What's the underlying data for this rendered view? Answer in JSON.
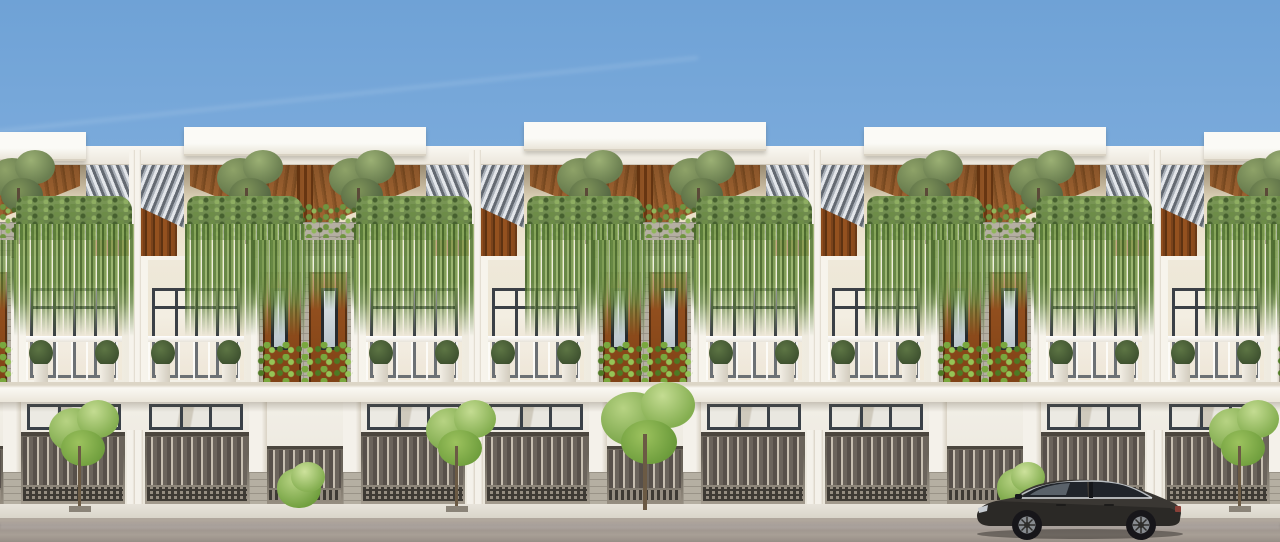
{
  "scene": {
    "type": "architectural-exterior-render",
    "subject": "Row of modern three-storey townhouses with timber slat accents, hanging balcony greenery, slatted metal fences, street trees and a parked charcoal wagon",
    "time_of_day": "day",
    "palette": {
      "sky_top": "#6fa2d6",
      "sky_horizon": "#a5c8e8",
      "facade_white": "#f6f3ec",
      "wall_cream": "#f0e8d6",
      "timber_brown": "#94511f",
      "wood_ceiling": "#9c6130",
      "louver_gray": "#9aa0a8",
      "window_frame": "#3a4148",
      "foliage_olive": "#79905a",
      "vine_green": "#7a9952",
      "street_tree_green": "#7ab04a",
      "stone_gray": "#b5afa2",
      "fence_dark": "#57504a",
      "street_gray": "#99908a",
      "car_charcoal": "#3a3733"
    },
    "units": [
      {
        "left": -205,
        "roof_rise": 10
      },
      {
        "left": 135,
        "roof_rise": 5
      },
      {
        "left": 475,
        "roof_rise": 0
      },
      {
        "left": 815,
        "roof_rise": 5
      },
      {
        "left": 1155,
        "roof_rise": 10
      }
    ],
    "street_plants": [
      {
        "x": 35,
        "kind": "tree"
      },
      {
        "x": 277,
        "kind": "bush"
      },
      {
        "x": 412,
        "kind": "tree"
      },
      {
        "x": 585,
        "kind": "tree-large"
      },
      {
        "x": 997,
        "kind": "bush"
      },
      {
        "x": 1195,
        "kind": "tree"
      }
    ],
    "car": {
      "left": 970,
      "top": 468,
      "width": 218,
      "height": 74,
      "facing": "left"
    }
  }
}
